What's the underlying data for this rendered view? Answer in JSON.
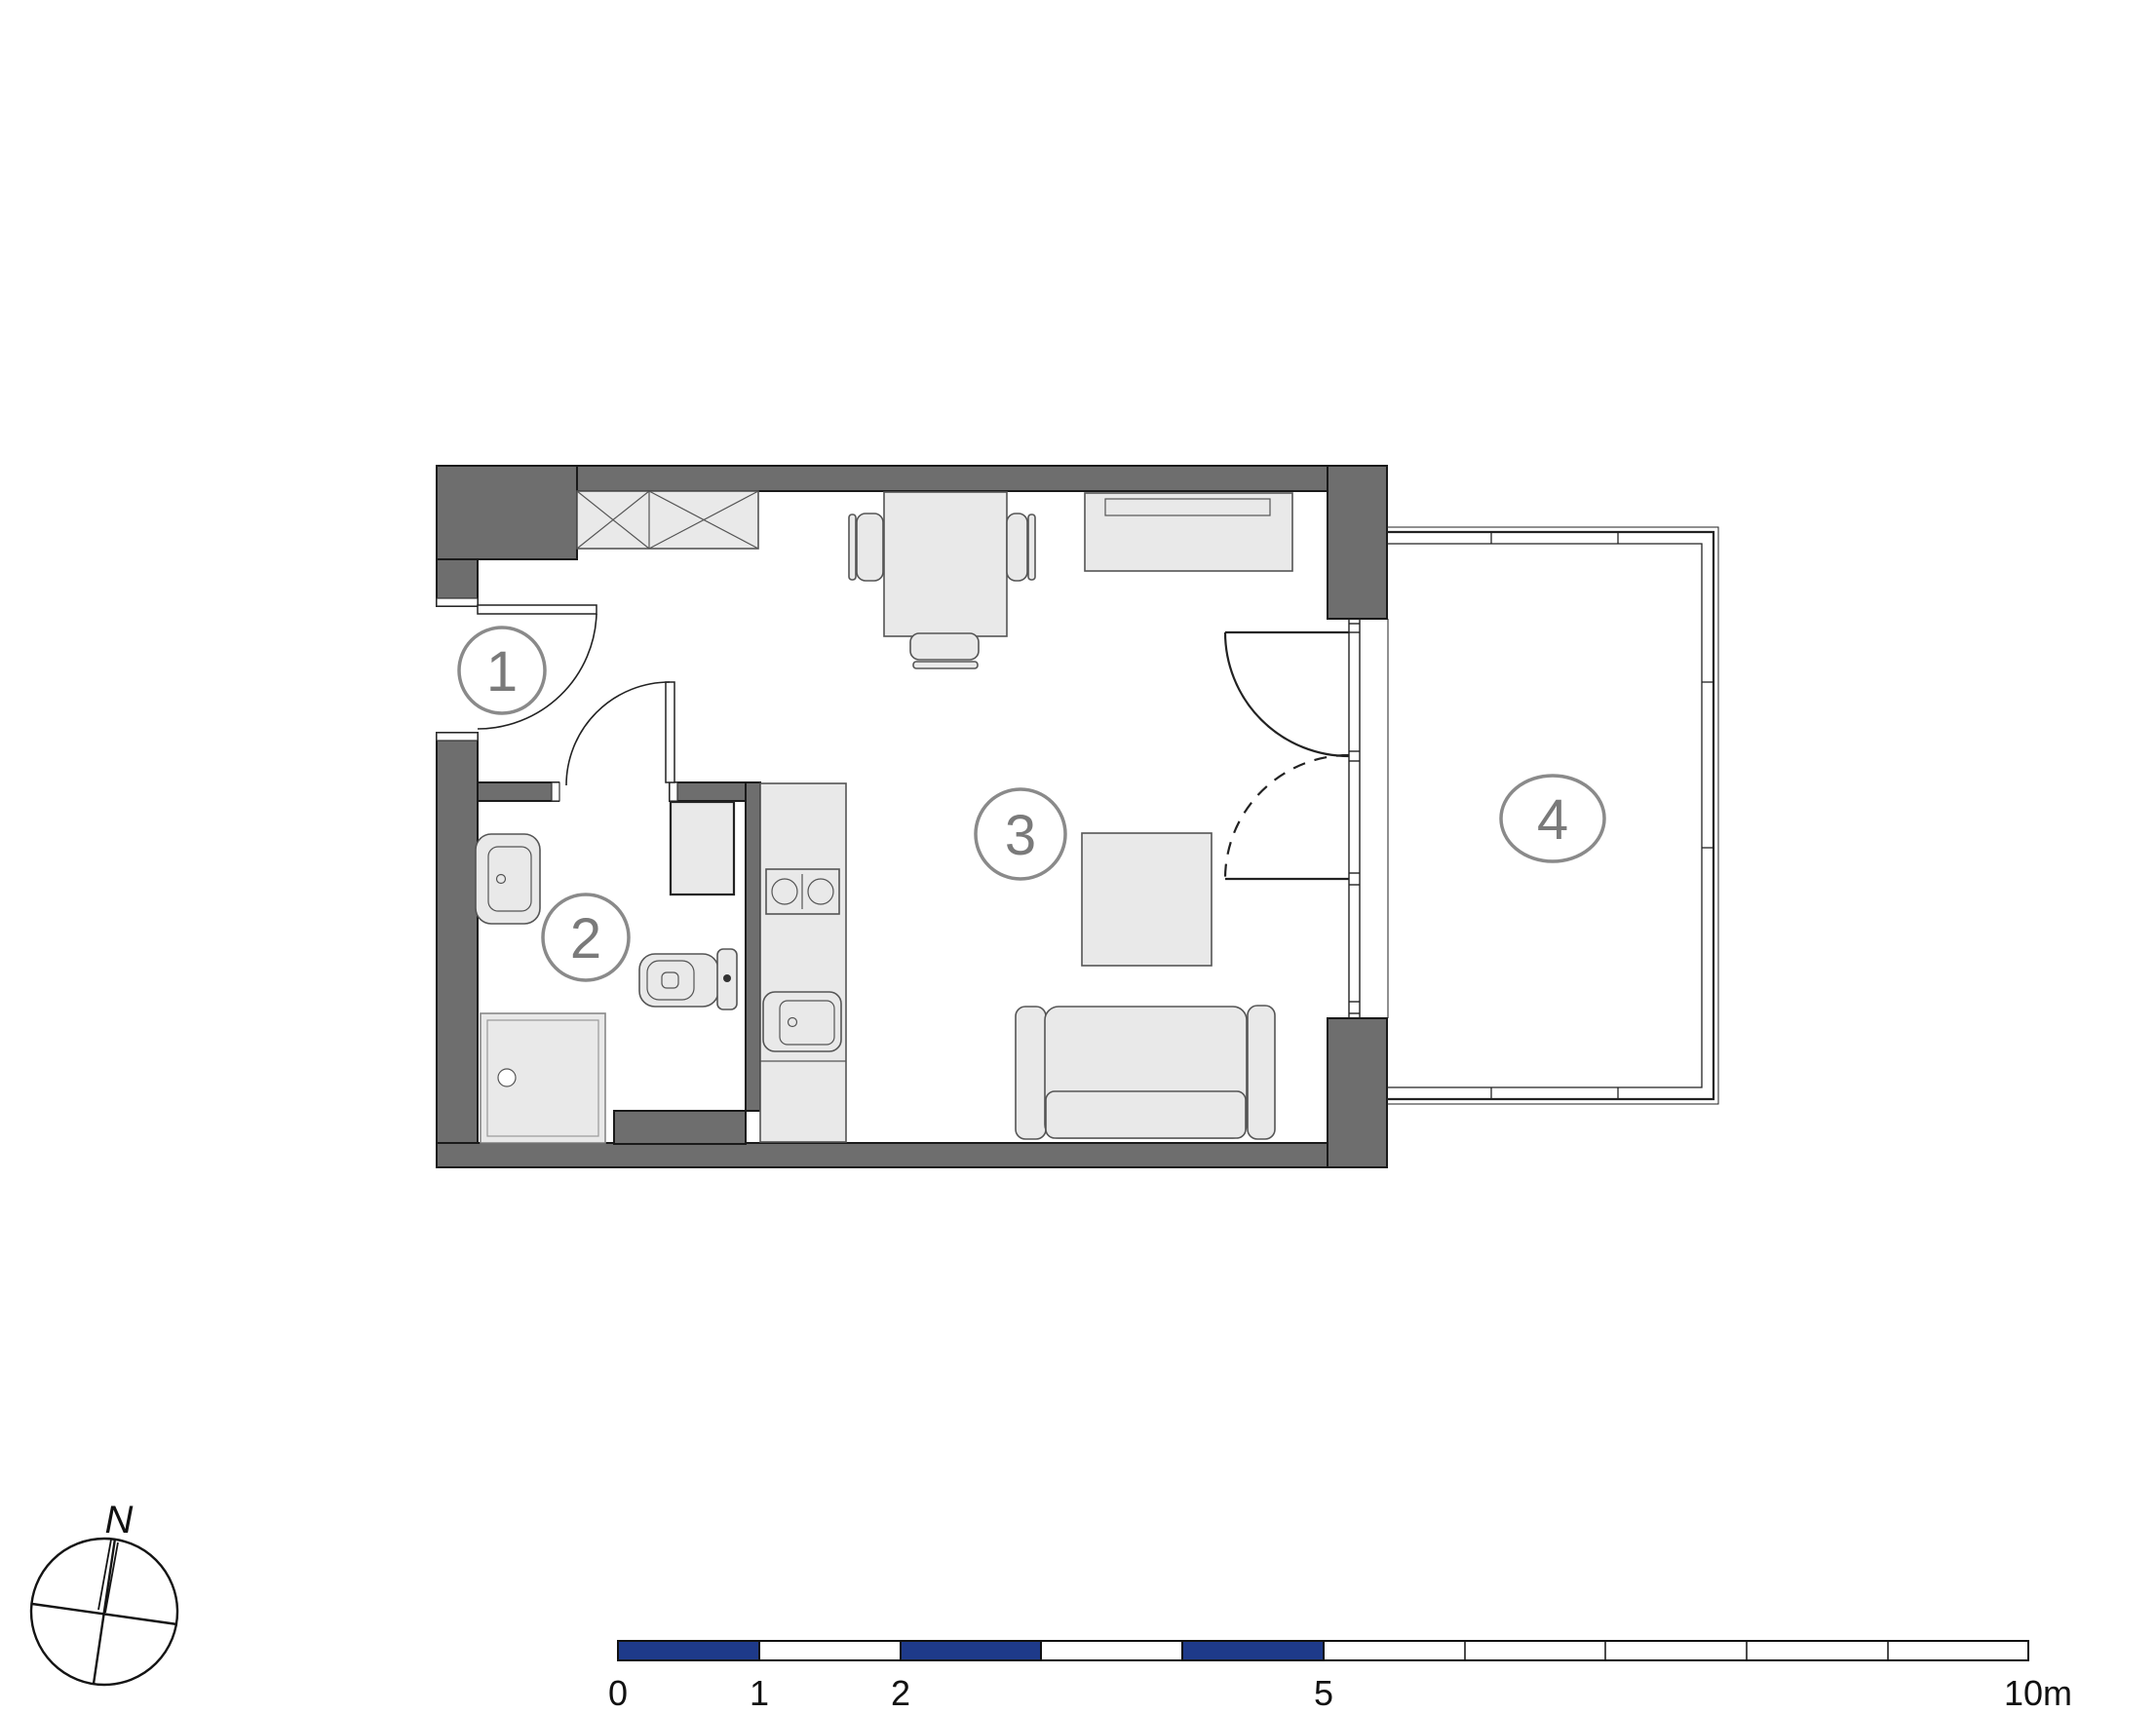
{
  "room_labels": {
    "hall": "1",
    "bathroom": "2",
    "living_room": "3",
    "balcony": "4"
  },
  "compass": {
    "north_label": "N"
  },
  "scale_bar": {
    "unit_labels": [
      "0",
      "1",
      "2",
      "5",
      "10m"
    ]
  },
  "colors": {
    "wall": "#6e6e6e",
    "furniture_fill": "#e9e9e9",
    "scale_blue": "#1e3a8a",
    "label_stroke": "#8a8a8a",
    "label_text": "#7a7a7a"
  }
}
